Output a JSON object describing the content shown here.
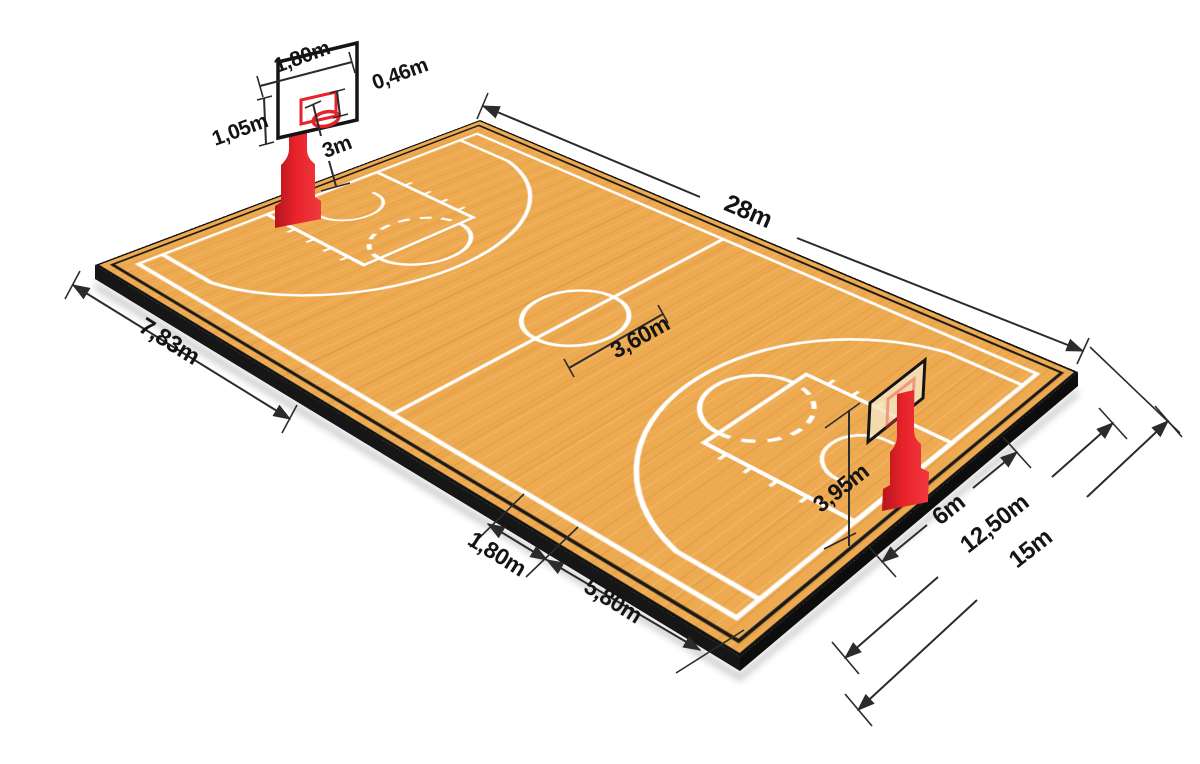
{
  "diagram": {
    "subject": "basketball-court-dimensions",
    "units": "m",
    "decimal_separator": ","
  },
  "dims": {
    "backboard_width": "1,80m",
    "rim_depth": "0,46m",
    "backboard_height": "1,05m",
    "rim_height": "3m",
    "court_length": "28m",
    "sideline_left_span": "7,83m",
    "center_circle_diameter": "3,60m",
    "lane_offset": "1,80m",
    "freethrow_distance": "5,80m",
    "backboard_top_height": "3,95m",
    "basket_span": "6m",
    "mid_span": "12,50m",
    "court_width": "15m"
  },
  "colors": {
    "floor": "#edaa50",
    "court_lines": "#ffffff",
    "slab_edge": "#141414",
    "accent_red": "#e8222a",
    "dimension_lines": "#2b2b2b",
    "background": "#ffffff"
  }
}
